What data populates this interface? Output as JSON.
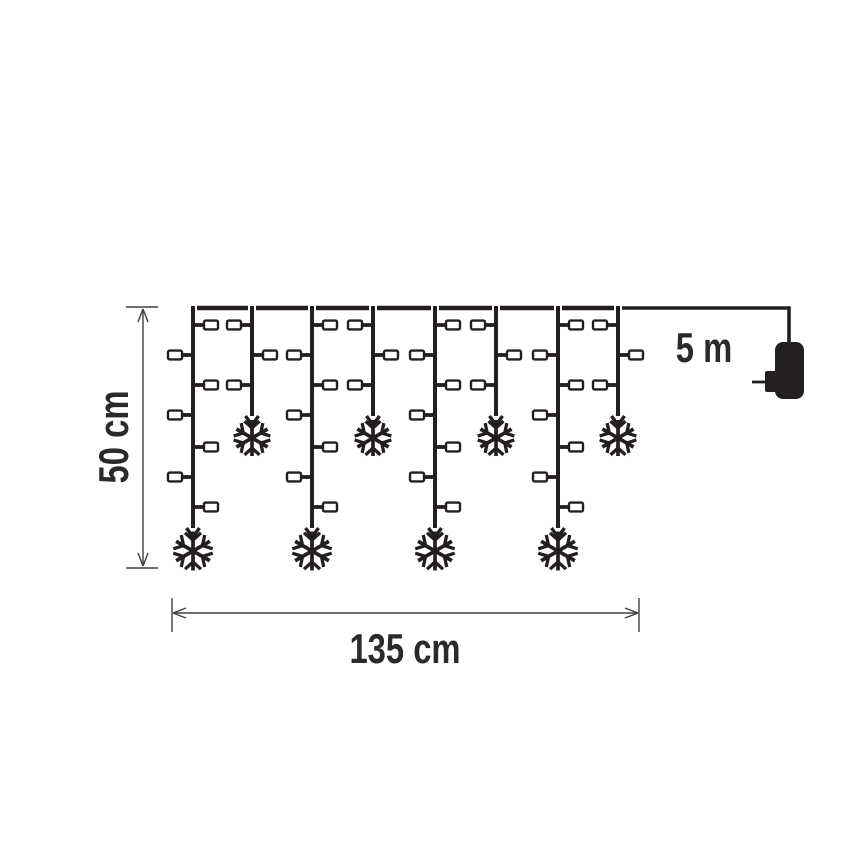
{
  "labels": {
    "height": "50 cm",
    "width": "135 cm",
    "lead_length": "5 m"
  },
  "colors": {
    "ink": "#231f20",
    "dim": "#3f3f3f",
    "bulb": "#ffffff",
    "background": "#ffffff",
    "text": "#2a2a2a"
  },
  "diagram": {
    "top_wire_y": 308,
    "drops": [
      {
        "x": 193,
        "type": "long"
      },
      {
        "x": 252,
        "type": "short"
      },
      {
        "x": 312,
        "type": "long"
      },
      {
        "x": 373,
        "type": "short"
      },
      {
        "x": 435,
        "type": "long"
      },
      {
        "x": 496,
        "type": "short"
      },
      {
        "x": 558,
        "type": "long"
      },
      {
        "x": 618,
        "type": "short"
      }
    ],
    "bulb_rows_y": [
      325,
      355,
      385,
      415,
      447,
      477,
      507
    ],
    "profiles": {
      "long": {
        "line_end_y": 528,
        "arrow_tip_y": 537,
        "flake_cy": 551,
        "flake_r": 19.5,
        "bulb_sides": [
          "R",
          "L",
          "R",
          "L",
          "R",
          "L",
          "R"
        ]
      },
      "short": {
        "line_end_y": 416,
        "arrow_tip_y": 425,
        "flake_cy": 438,
        "flake_r": 18,
        "bulb_sides": [
          "L",
          "R",
          "L"
        ]
      }
    },
    "lead": {
      "corner_x": 789
    },
    "plug": {
      "body": {
        "x": 775,
        "y": 342,
        "w": 29,
        "h": 57,
        "r": 8
      },
      "collar": {
        "x": 765,
        "y": 371,
        "w": 12,
        "h": 21
      },
      "prong": {
        "x1": 752,
        "x2": 766,
        "y": 382
      }
    },
    "dim_height": {
      "x": 143,
      "y1": 308,
      "y2": 567,
      "tick_x1": 126,
      "tick_x2": 158
    },
    "dim_width": {
      "y": 613,
      "x1": 172,
      "x2": 639,
      "tick_y1": 598,
      "tick_y2": 632
    }
  }
}
